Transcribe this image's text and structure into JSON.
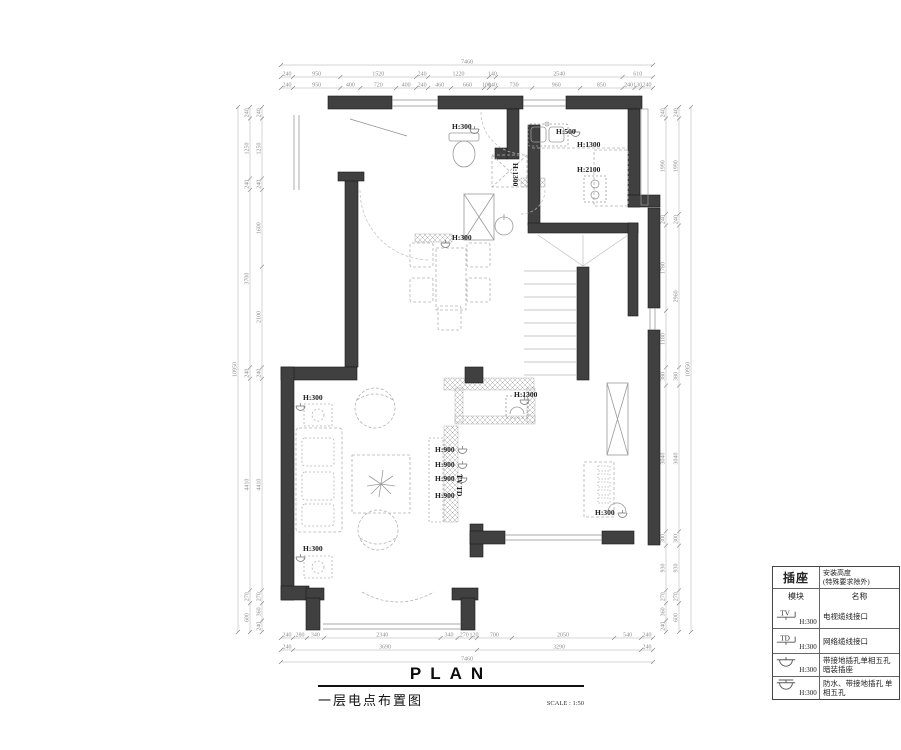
{
  "title_block": {
    "plan_word": "PLAN",
    "drawing_title": "一层电点布置图",
    "scale_label": "SCALE : 1:50"
  },
  "legend": {
    "header_title": "插座",
    "header_height_line1": "安装高度",
    "header_height_line2": "(特殊要求除外)",
    "module_header": "模块",
    "name_header": "名称",
    "rows": [
      {
        "icon": "tv-socket-icon",
        "icon_label": "TV",
        "height": "H:300",
        "name": "电视缆线接口"
      },
      {
        "icon": "network-socket-icon",
        "icon_label": "TD",
        "height": "H:300",
        "name": "网络缆线接口"
      },
      {
        "icon": "socket-icon",
        "icon_label": "",
        "height": "H:300",
        "name": "带接地插孔单相五孔 暗装插座"
      },
      {
        "icon": "waterproof-socket-icon",
        "icon_label": "",
        "height": "H:300",
        "name": "防水、带接地插孔 单相五孔"
      }
    ]
  },
  "plan_labels": [
    {
      "text": "H:300",
      "x": 452,
      "y": 129
    },
    {
      "text": "H:500",
      "x": 556,
      "y": 134
    },
    {
      "text": "H:1300",
      "x": 577,
      "y": 147
    },
    {
      "text": "H:2100",
      "x": 577,
      "y": 172
    },
    {
      "text": "H:1300",
      "x": 513,
      "y": 163,
      "rot": 90
    },
    {
      "text": "H:300",
      "x": 452,
      "y": 240
    },
    {
      "text": "H:300",
      "x": 303,
      "y": 400
    },
    {
      "text": "H:300",
      "x": 303,
      "y": 551
    },
    {
      "text": "H:900",
      "x": 435,
      "y": 452
    },
    {
      "text": "H:900",
      "x": 435,
      "y": 467
    },
    {
      "text": "H:900",
      "x": 435,
      "y": 481
    },
    {
      "text": "H:900",
      "x": 435,
      "y": 498
    },
    {
      "text": "TV TD",
      "x": 457,
      "y": 474,
      "rot": 90
    },
    {
      "text": "H:1300",
      "x": 514,
      "y": 397
    },
    {
      "text": "H:300",
      "x": 595,
      "y": 515
    }
  ],
  "dimensions": {
    "chains": [
      {
        "side": "top",
        "at": 88,
        "from": 281,
        "to": 653,
        "values": [
          "240",
          "950",
          "400",
          "720",
          "400",
          "240",
          "460",
          "660",
          "100",
          "140",
          "730",
          "960",
          "850",
          "240",
          "130",
          "240"
        ]
      },
      {
        "side": "top",
        "at": 77,
        "from": 281,
        "to": 653,
        "values": [
          "240",
          "950",
          "1520",
          "240",
          "1220",
          "140",
          "2540",
          "610"
        ]
      },
      {
        "side": "top",
        "at": 65,
        "from": 281,
        "to": 653,
        "values": [
          "7460"
        ]
      },
      {
        "side": "bottom",
        "at": 638,
        "from": 281,
        "to": 653,
        "values": [
          "240",
          "280",
          "340",
          "2340",
          "340",
          "270",
          "120",
          "700",
          "2050",
          "540",
          "240"
        ]
      },
      {
        "side": "bottom",
        "at": 650,
        "from": 281,
        "to": 653,
        "values": [
          "240",
          "3690",
          "3290",
          "240"
        ]
      },
      {
        "side": "bottom",
        "at": 662,
        "from": 281,
        "to": 653,
        "values": [
          "7460"
        ]
      },
      {
        "side": "left",
        "at": 262,
        "from": 107,
        "to": 632,
        "values": [
          "240",
          "1250",
          "240",
          "1600",
          "2100",
          "240",
          "4410",
          "270",
          "360",
          "240"
        ]
      },
      {
        "side": "left",
        "at": 250,
        "from": 107,
        "to": 632,
        "values": [
          "240",
          "1250",
          "240",
          "3700",
          "240",
          "4410",
          "270",
          "600"
        ]
      },
      {
        "side": "left",
        "at": 238,
        "from": 107,
        "to": 632,
        "values": [
          "10950"
        ]
      },
      {
        "side": "right",
        "at": 666,
        "from": 107,
        "to": 632,
        "values": [
          "240",
          "1990",
          "240",
          "1780",
          "1180",
          "380",
          "3040",
          "300",
          "930",
          "270",
          "360",
          "240"
        ]
      },
      {
        "side": "right",
        "at": 679,
        "from": 107,
        "to": 632,
        "values": [
          "240",
          "1990",
          "240",
          "2960",
          "380",
          "3040",
          "300",
          "930",
          "270",
          "600"
        ]
      },
      {
        "side": "right",
        "at": 691,
        "from": 107,
        "to": 632,
        "values": [
          "10950"
        ]
      }
    ]
  },
  "colors": {
    "wall_fill": "#404040",
    "wall_edge": "#1a1a1a",
    "dim_line": "#ababab",
    "dim_text": "#8f8f8f",
    "furniture": "#b2b2b2",
    "fixture": "#9a9a9a",
    "hatch": "#9f9f9f",
    "label_text": "#1c1c1c"
  }
}
